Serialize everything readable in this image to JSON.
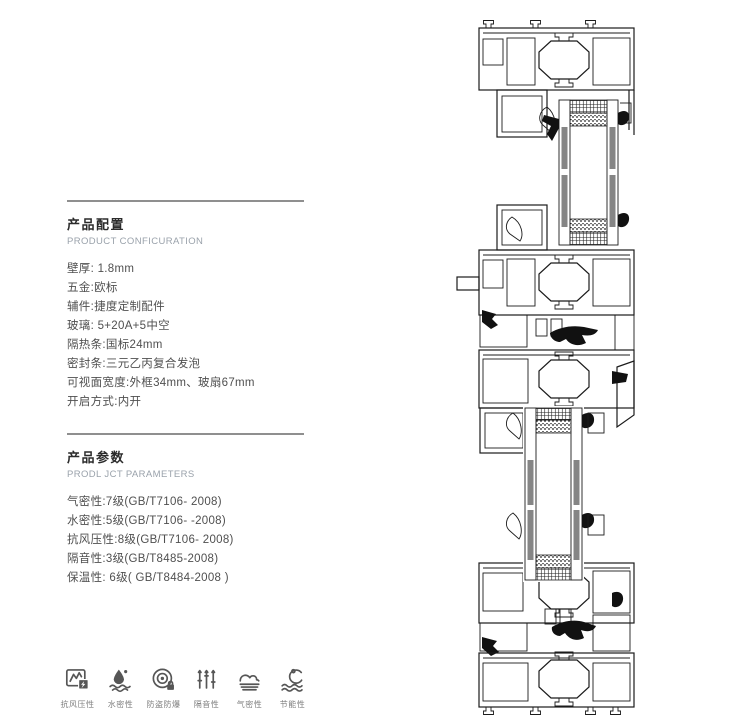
{
  "config_section": {
    "title": "产品配置",
    "subtitle": "PRODUCT CONFICURATION",
    "items": [
      "壁厚: 1.8mm",
      "五金:欧标",
      "辅件:捷度定制配件",
      "玻璃: 5+20A+5中空",
      "隔热条:国标24mm",
      "密封条:三元乙丙复合发泡",
      "可视面宽度:外框34mm、玻扇67mm",
      "开启方式:内开"
    ]
  },
  "params_section": {
    "title": "产品参数",
    "subtitle": "PRODL JCT PARAMETERS",
    "items": [
      "气密性:7级(GB/T7106- 2008)",
      "水密性:5级(GB/T7106- -2008)",
      "抗风压性:8级(GB/T7106- 2008)",
      "隔音性:3级(GB/T8485-2008)",
      "保温性: 6级( GB/T8484-2008 )"
    ]
  },
  "features": {
    "items": [
      {
        "icon": "wind-pressure-icon",
        "label": "抗风压性"
      },
      {
        "icon": "water-tightness-icon",
        "label": "水密性"
      },
      {
        "icon": "anti-theft-icon",
        "label": "防盗防爆"
      },
      {
        "icon": "sound-insulation-icon",
        "label": "隔音性"
      },
      {
        "icon": "air-tightness-icon",
        "label": "气密性"
      },
      {
        "icon": "energy-saving-icon",
        "label": "节能性"
      }
    ]
  },
  "drawing": {
    "name": "aluminum-window-profile-cross-section"
  },
  "colors": {
    "text_primary": "#2b2b2b",
    "text_body": "#4f4f4f",
    "text_muted": "#9aa2ab",
    "divider": "#8f8f8f",
    "icon_gray": "#565656",
    "drawing_line": "#1b1b1b"
  }
}
